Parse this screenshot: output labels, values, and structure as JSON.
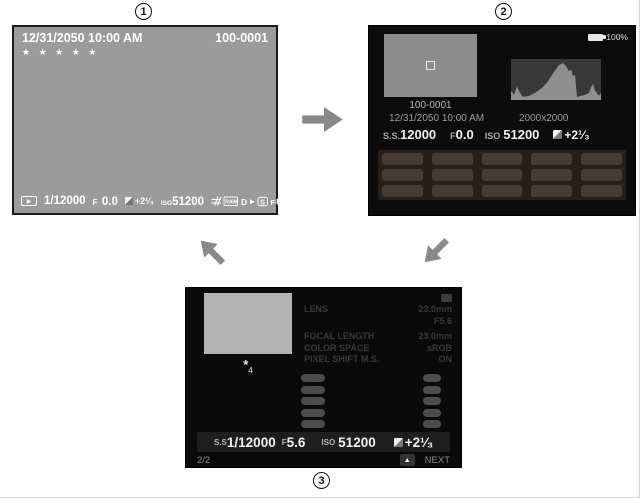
{
  "steps": {
    "step1": "1",
    "step2": "2",
    "step3": "3"
  },
  "screen1": {
    "datetime": "12/31/2050 10:00 AM",
    "frame_number": "100-0001",
    "rating": "★ ★ ★ ★ ★",
    "play_icon": "▶",
    "shutter_speed": "1/12000",
    "aperture_label": "F",
    "aperture_value": "0.0",
    "ev_value": "+2¹⁄₃",
    "iso_label": "ISO",
    "iso_value": "51200"
  },
  "screen2": {
    "battery_percent": "100%",
    "frame_number": "100-0001",
    "datetime": "12/31/2050 10:00 AM",
    "pixel_dimensions": "2000x2000",
    "shutter_label": "S.S.",
    "shutter_value": "12000",
    "aperture_label": "F",
    "aperture_value": "0.0",
    "iso_label": "ISO",
    "iso_value": "51200",
    "ev_value": "+2¹⁄₃"
  },
  "chart_data": {
    "type": "area",
    "title": "Brightness histogram on screen 2",
    "xlabel": "luminance (shadows to highlights)",
    "ylabel": "pixel count",
    "legend": "none",
    "points": "0,40 0,31 3,35 6,27 9,33 12,37 18,36 24,33 30,29 36,23 42,14 48,6 52,4 55,7 58,12 60,10 62,17 64,15 66,37 70,36 74,35 78,33 80,28 82,24 84,31 88,36 90,33 90,40"
  },
  "screen3": {
    "footnote_symbol": "*",
    "footnote_index": "4",
    "info_rows": [
      {
        "label": "LENS",
        "value": "23.0mm"
      },
      {
        "label": "",
        "value": "F5.6"
      },
      {
        "label": "FOCAL LENGTH",
        "value": "23.0mm"
      },
      {
        "label": "COLOR SPACE",
        "value": "sRGB"
      },
      {
        "label": "PIXEL SHIFT M.S.",
        "value": "ON"
      }
    ],
    "shutter_label": "S.S",
    "shutter_value": "1/12000",
    "aperture_label": "F",
    "aperture_value": "5.6",
    "iso_label": "ISO",
    "iso_value": "51200",
    "ev_value": "+2¹⁄₃",
    "page_indicator": "2/2",
    "next_icon": "▲",
    "next_label": "NEXT"
  }
}
